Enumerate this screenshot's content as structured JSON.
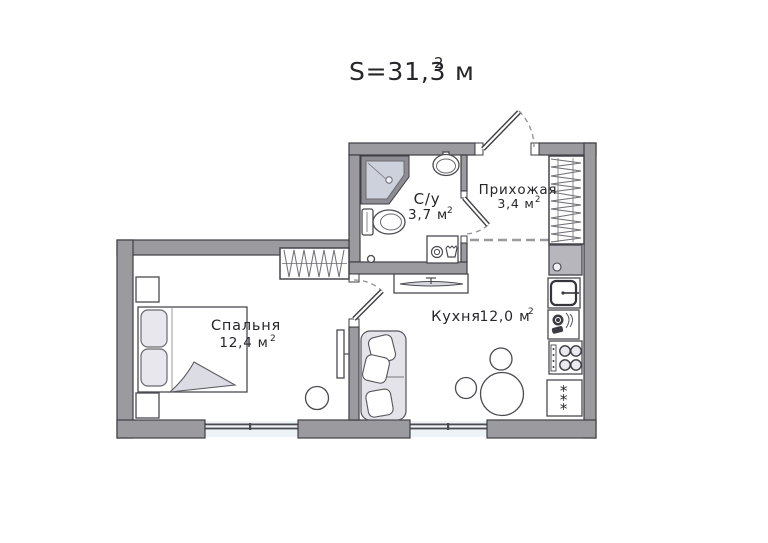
{
  "title": {
    "text": "S=31,3 м",
    "sup": "2"
  },
  "rooms": {
    "bedroom": {
      "name": "Спальня",
      "area": "12,4 м",
      "area_sup": "2"
    },
    "kitchen": {
      "name": "Кухня",
      "area": "12,0 м",
      "area_sup": "2"
    },
    "bathroom": {
      "name": "С/у",
      "area": "3,7 м",
      "area_sup": "2"
    },
    "hallway": {
      "name": "Прихожая",
      "area": "3,4 м",
      "area_sup": "2"
    }
  },
  "icons": {
    "fridge_stars": "***",
    "legend": [
      "shower-icon",
      "sink-icon",
      "toilet-icon",
      "washing-machine-icon",
      "wardrobe-icon",
      "bed-icon",
      "sofa-icon",
      "dining-table-icon",
      "stove-icon",
      "fridge-icon",
      "dishwasher-icon",
      "tv-icon"
    ]
  },
  "colors": {
    "wall": "#9b9b9f",
    "wall_outline": "#3e3e44",
    "appliance_gray": "#b6b6bc",
    "shower_rim": "#8d8d93",
    "shower_fill": "#cdd1db",
    "furniture_fill": "#e3e3e9",
    "blanket_fill": "#dcdce4",
    "window_glass": "#eef3f8",
    "text": "#26262a",
    "background": "#ffffff"
  }
}
